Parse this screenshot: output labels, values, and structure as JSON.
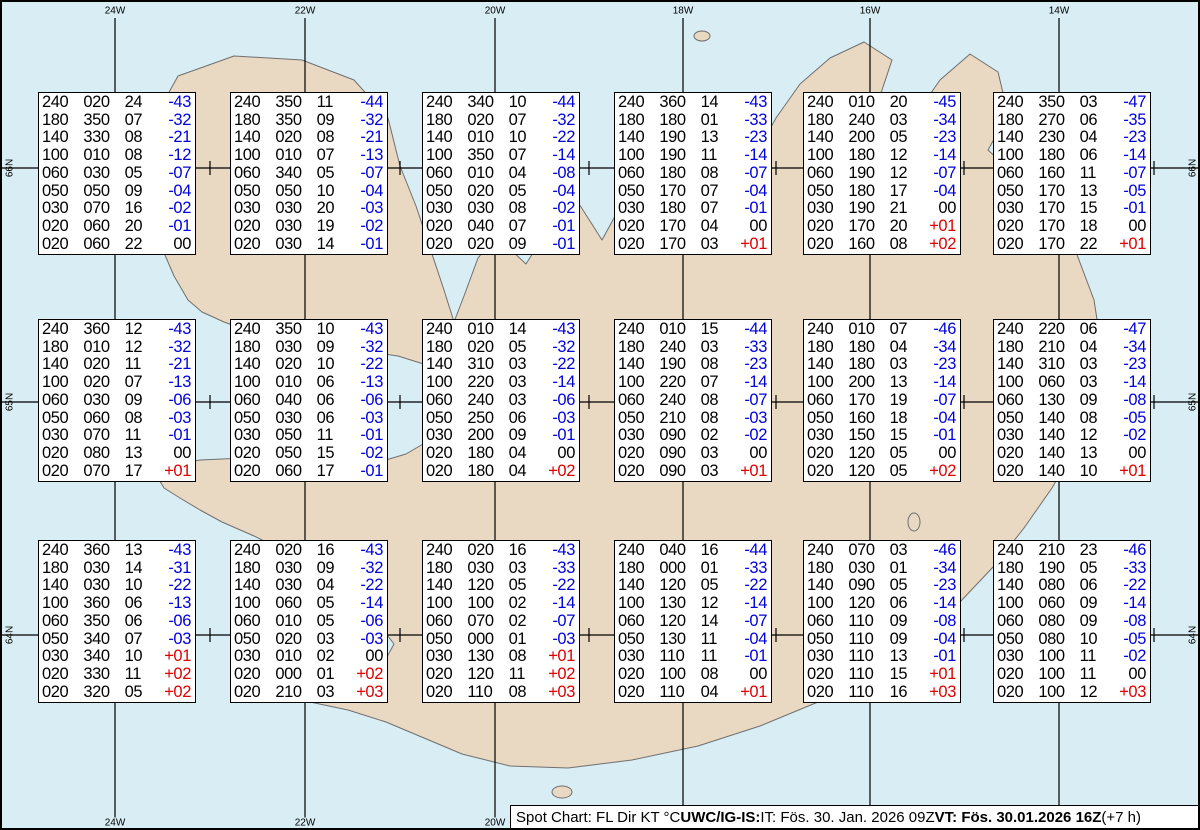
{
  "map": {
    "sea_color": "#d8edf4",
    "land_color": "#e9d8c2",
    "coast_color": "#6f6f6f",
    "grid_color": "#000000",
    "top_labels": [
      "24W",
      "22W",
      "20W",
      "18W",
      "16W",
      "14W"
    ],
    "bottom_labels": [
      "24W",
      "22W",
      "20W"
    ],
    "left_labels": [
      "66N",
      "65N",
      "64N"
    ],
    "right_labels": [
      "66N",
      "65N",
      "64N"
    ]
  },
  "legend_columns": [
    "FL",
    "Dir",
    "KT",
    "°C"
  ],
  "temp_colors": {
    "negative": "#0000dd",
    "positive": "#dd0000",
    "zero": "#000000"
  },
  "spot_boxes": [
    {
      "rows": [
        [
          "240",
          "020",
          "24",
          "-43"
        ],
        [
          "180",
          "350",
          "07",
          "-32"
        ],
        [
          "140",
          "330",
          "08",
          "-21"
        ],
        [
          "100",
          "010",
          "08",
          "-12"
        ],
        [
          "060",
          "030",
          "05",
          "-07"
        ],
        [
          "050",
          "050",
          "09",
          "-04"
        ],
        [
          "030",
          "070",
          "16",
          "-02"
        ],
        [
          "020",
          "060",
          "20",
          "-01"
        ],
        [
          "020",
          "060",
          "22",
          "00"
        ]
      ]
    },
    {
      "rows": [
        [
          "240",
          "350",
          "11",
          "-44"
        ],
        [
          "180",
          "350",
          "09",
          "-32"
        ],
        [
          "140",
          "020",
          "08",
          "-21"
        ],
        [
          "100",
          "010",
          "07",
          "-13"
        ],
        [
          "060",
          "340",
          "05",
          "-07"
        ],
        [
          "050",
          "050",
          "10",
          "-04"
        ],
        [
          "030",
          "030",
          "20",
          "-03"
        ],
        [
          "020",
          "030",
          "19",
          "-02"
        ],
        [
          "020",
          "030",
          "14",
          "-01"
        ]
      ]
    },
    {
      "rows": [
        [
          "240",
          "340",
          "10",
          "-44"
        ],
        [
          "180",
          "020",
          "07",
          "-32"
        ],
        [
          "140",
          "010",
          "10",
          "-22"
        ],
        [
          "100",
          "350",
          "07",
          "-14"
        ],
        [
          "060",
          "010",
          "04",
          "-08"
        ],
        [
          "050",
          "020",
          "05",
          "-04"
        ],
        [
          "030",
          "030",
          "08",
          "-02"
        ],
        [
          "020",
          "040",
          "07",
          "-01"
        ],
        [
          "020",
          "020",
          "09",
          "-01"
        ]
      ]
    },
    {
      "rows": [
        [
          "240",
          "360",
          "14",
          "-43"
        ],
        [
          "180",
          "180",
          "01",
          "-33"
        ],
        [
          "140",
          "190",
          "13",
          "-23"
        ],
        [
          "100",
          "190",
          "11",
          "-14"
        ],
        [
          "060",
          "180",
          "08",
          "-07"
        ],
        [
          "050",
          "170",
          "07",
          "-04"
        ],
        [
          "030",
          "180",
          "07",
          "-01"
        ],
        [
          "020",
          "170",
          "04",
          "00"
        ],
        [
          "020",
          "170",
          "03",
          "+01"
        ]
      ]
    },
    {
      "rows": [
        [
          "240",
          "010",
          "20",
          "-45"
        ],
        [
          "180",
          "240",
          "03",
          "-34"
        ],
        [
          "140",
          "200",
          "05",
          "-23"
        ],
        [
          "100",
          "180",
          "12",
          "-14"
        ],
        [
          "060",
          "190",
          "12",
          "-07"
        ],
        [
          "050",
          "180",
          "17",
          "-04"
        ],
        [
          "030",
          "190",
          "21",
          "00"
        ],
        [
          "020",
          "170",
          "20",
          "+01"
        ],
        [
          "020",
          "160",
          "08",
          "+02"
        ]
      ]
    },
    {
      "rows": [
        [
          "240",
          "350",
          "03",
          "-47"
        ],
        [
          "180",
          "270",
          "06",
          "-35"
        ],
        [
          "140",
          "230",
          "04",
          "-23"
        ],
        [
          "100",
          "180",
          "06",
          "-14"
        ],
        [
          "060",
          "160",
          "11",
          "-07"
        ],
        [
          "050",
          "170",
          "13",
          "-05"
        ],
        [
          "030",
          "170",
          "15",
          "-01"
        ],
        [
          "020",
          "170",
          "18",
          "00"
        ],
        [
          "020",
          "170",
          "22",
          "+01"
        ]
      ]
    },
    {
      "rows": [
        [
          "240",
          "360",
          "12",
          "-43"
        ],
        [
          "180",
          "010",
          "12",
          "-32"
        ],
        [
          "140",
          "020",
          "11",
          "-21"
        ],
        [
          "100",
          "020",
          "07",
          "-13"
        ],
        [
          "060",
          "030",
          "09",
          "-06"
        ],
        [
          "050",
          "060",
          "08",
          "-03"
        ],
        [
          "030",
          "070",
          "11",
          "-01"
        ],
        [
          "020",
          "080",
          "13",
          "00"
        ],
        [
          "020",
          "070",
          "17",
          "+01"
        ]
      ]
    },
    {
      "rows": [
        [
          "240",
          "350",
          "10",
          "-43"
        ],
        [
          "180",
          "030",
          "09",
          "-32"
        ],
        [
          "140",
          "020",
          "10",
          "-22"
        ],
        [
          "100",
          "010",
          "06",
          "-13"
        ],
        [
          "060",
          "040",
          "06",
          "-06"
        ],
        [
          "050",
          "030",
          "06",
          "-03"
        ],
        [
          "030",
          "050",
          "11",
          "-01"
        ],
        [
          "020",
          "050",
          "15",
          "-02"
        ],
        [
          "020",
          "060",
          "17",
          "-01"
        ]
      ]
    },
    {
      "rows": [
        [
          "240",
          "010",
          "14",
          "-43"
        ],
        [
          "180",
          "020",
          "05",
          "-32"
        ],
        [
          "140",
          "310",
          "03",
          "-22"
        ],
        [
          "100",
          "220",
          "03",
          "-14"
        ],
        [
          "060",
          "240",
          "03",
          "-06"
        ],
        [
          "050",
          "250",
          "06",
          "-03"
        ],
        [
          "030",
          "200",
          "09",
          "-01"
        ],
        [
          "020",
          "180",
          "04",
          "00"
        ],
        [
          "020",
          "180",
          "04",
          "+02"
        ]
      ]
    },
    {
      "rows": [
        [
          "240",
          "010",
          "15",
          "-44"
        ],
        [
          "180",
          "240",
          "03",
          "-33"
        ],
        [
          "140",
          "190",
          "08",
          "-23"
        ],
        [
          "100",
          "220",
          "07",
          "-14"
        ],
        [
          "060",
          "240",
          "08",
          "-07"
        ],
        [
          "050",
          "210",
          "08",
          "-03"
        ],
        [
          "030",
          "090",
          "02",
          "-02"
        ],
        [
          "020",
          "090",
          "03",
          "00"
        ],
        [
          "020",
          "090",
          "03",
          "+01"
        ]
      ]
    },
    {
      "rows": [
        [
          "240",
          "010",
          "07",
          "-46"
        ],
        [
          "180",
          "180",
          "04",
          "-34"
        ],
        [
          "140",
          "180",
          "03",
          "-23"
        ],
        [
          "100",
          "200",
          "13",
          "-14"
        ],
        [
          "060",
          "170",
          "19",
          "-07"
        ],
        [
          "050",
          "160",
          "18",
          "-04"
        ],
        [
          "030",
          "150",
          "15",
          "-01"
        ],
        [
          "020",
          "120",
          "05",
          "00"
        ],
        [
          "020",
          "120",
          "05",
          "+02"
        ]
      ]
    },
    {
      "rows": [
        [
          "240",
          "220",
          "06",
          "-47"
        ],
        [
          "180",
          "210",
          "04",
          "-34"
        ],
        [
          "140",
          "310",
          "03",
          "-23"
        ],
        [
          "100",
          "060",
          "03",
          "-14"
        ],
        [
          "060",
          "130",
          "09",
          "-08"
        ],
        [
          "050",
          "140",
          "08",
          "-05"
        ],
        [
          "030",
          "140",
          "12",
          "-02"
        ],
        [
          "020",
          "140",
          "13",
          "00"
        ],
        [
          "020",
          "140",
          "10",
          "+01"
        ]
      ]
    },
    {
      "rows": [
        [
          "240",
          "360",
          "13",
          "-43"
        ],
        [
          "180",
          "030",
          "14",
          "-31"
        ],
        [
          "140",
          "030",
          "10",
          "-22"
        ],
        [
          "100",
          "360",
          "06",
          "-13"
        ],
        [
          "060",
          "350",
          "06",
          "-06"
        ],
        [
          "050",
          "340",
          "07",
          "-03"
        ],
        [
          "030",
          "340",
          "10",
          "+01"
        ],
        [
          "020",
          "330",
          "11",
          "+02"
        ],
        [
          "020",
          "320",
          "05",
          "+02"
        ]
      ]
    },
    {
      "rows": [
        [
          "240",
          "020",
          "16",
          "-43"
        ],
        [
          "180",
          "030",
          "09",
          "-32"
        ],
        [
          "140",
          "030",
          "04",
          "-22"
        ],
        [
          "100",
          "060",
          "05",
          "-14"
        ],
        [
          "060",
          "010",
          "05",
          "-06"
        ],
        [
          "050",
          "020",
          "03",
          "-03"
        ],
        [
          "030",
          "010",
          "02",
          "00"
        ],
        [
          "020",
          "000",
          "01",
          "+02"
        ],
        [
          "020",
          "210",
          "03",
          "+03"
        ]
      ]
    },
    {
      "rows": [
        [
          "240",
          "020",
          "16",
          "-43"
        ],
        [
          "180",
          "030",
          "03",
          "-33"
        ],
        [
          "140",
          "120",
          "05",
          "-22"
        ],
        [
          "100",
          "100",
          "02",
          "-14"
        ],
        [
          "060",
          "070",
          "02",
          "-07"
        ],
        [
          "050",
          "000",
          "01",
          "-03"
        ],
        [
          "030",
          "130",
          "08",
          "+01"
        ],
        [
          "020",
          "120",
          "11",
          "+02"
        ],
        [
          "020",
          "110",
          "08",
          "+03"
        ]
      ]
    },
    {
      "rows": [
        [
          "240",
          "040",
          "16",
          "-44"
        ],
        [
          "180",
          "000",
          "01",
          "-33"
        ],
        [
          "140",
          "120",
          "05",
          "-22"
        ],
        [
          "100",
          "130",
          "12",
          "-14"
        ],
        [
          "060",
          "120",
          "14",
          "-07"
        ],
        [
          "050",
          "130",
          "11",
          "-04"
        ],
        [
          "030",
          "110",
          "11",
          "-01"
        ],
        [
          "020",
          "100",
          "08",
          "00"
        ],
        [
          "020",
          "110",
          "04",
          "+01"
        ]
      ]
    },
    {
      "rows": [
        [
          "240",
          "070",
          "03",
          "-46"
        ],
        [
          "180",
          "030",
          "01",
          "-34"
        ],
        [
          "140",
          "090",
          "05",
          "-23"
        ],
        [
          "100",
          "120",
          "06",
          "-14"
        ],
        [
          "060",
          "110",
          "09",
          "-08"
        ],
        [
          "050",
          "110",
          "09",
          "-04"
        ],
        [
          "030",
          "110",
          "13",
          "-01"
        ],
        [
          "020",
          "110",
          "15",
          "+01"
        ],
        [
          "020",
          "110",
          "16",
          "+03"
        ]
      ]
    },
    {
      "rows": [
        [
          "240",
          "210",
          "23",
          "-46"
        ],
        [
          "180",
          "190",
          "05",
          "-33"
        ],
        [
          "140",
          "080",
          "06",
          "-22"
        ],
        [
          "100",
          "060",
          "09",
          "-14"
        ],
        [
          "060",
          "080",
          "09",
          "-08"
        ],
        [
          "050",
          "080",
          "10",
          "-05"
        ],
        [
          "030",
          "100",
          "11",
          "-02"
        ],
        [
          "020",
          "100",
          "11",
          "00"
        ],
        [
          "020",
          "100",
          "12",
          "+03"
        ]
      ]
    }
  ],
  "status_bar": {
    "label_normal_1": "Spot Chart: FL Dir KT °C ",
    "label_bold_1": "UWC/IG-IS:",
    "label_normal_2": " IT: Fös. 30. Jan. 2026 09Z ",
    "label_bold_2": "VT: Fös. 30.01.2026 16Z",
    "label_normal_3": " (+7 h)"
  }
}
